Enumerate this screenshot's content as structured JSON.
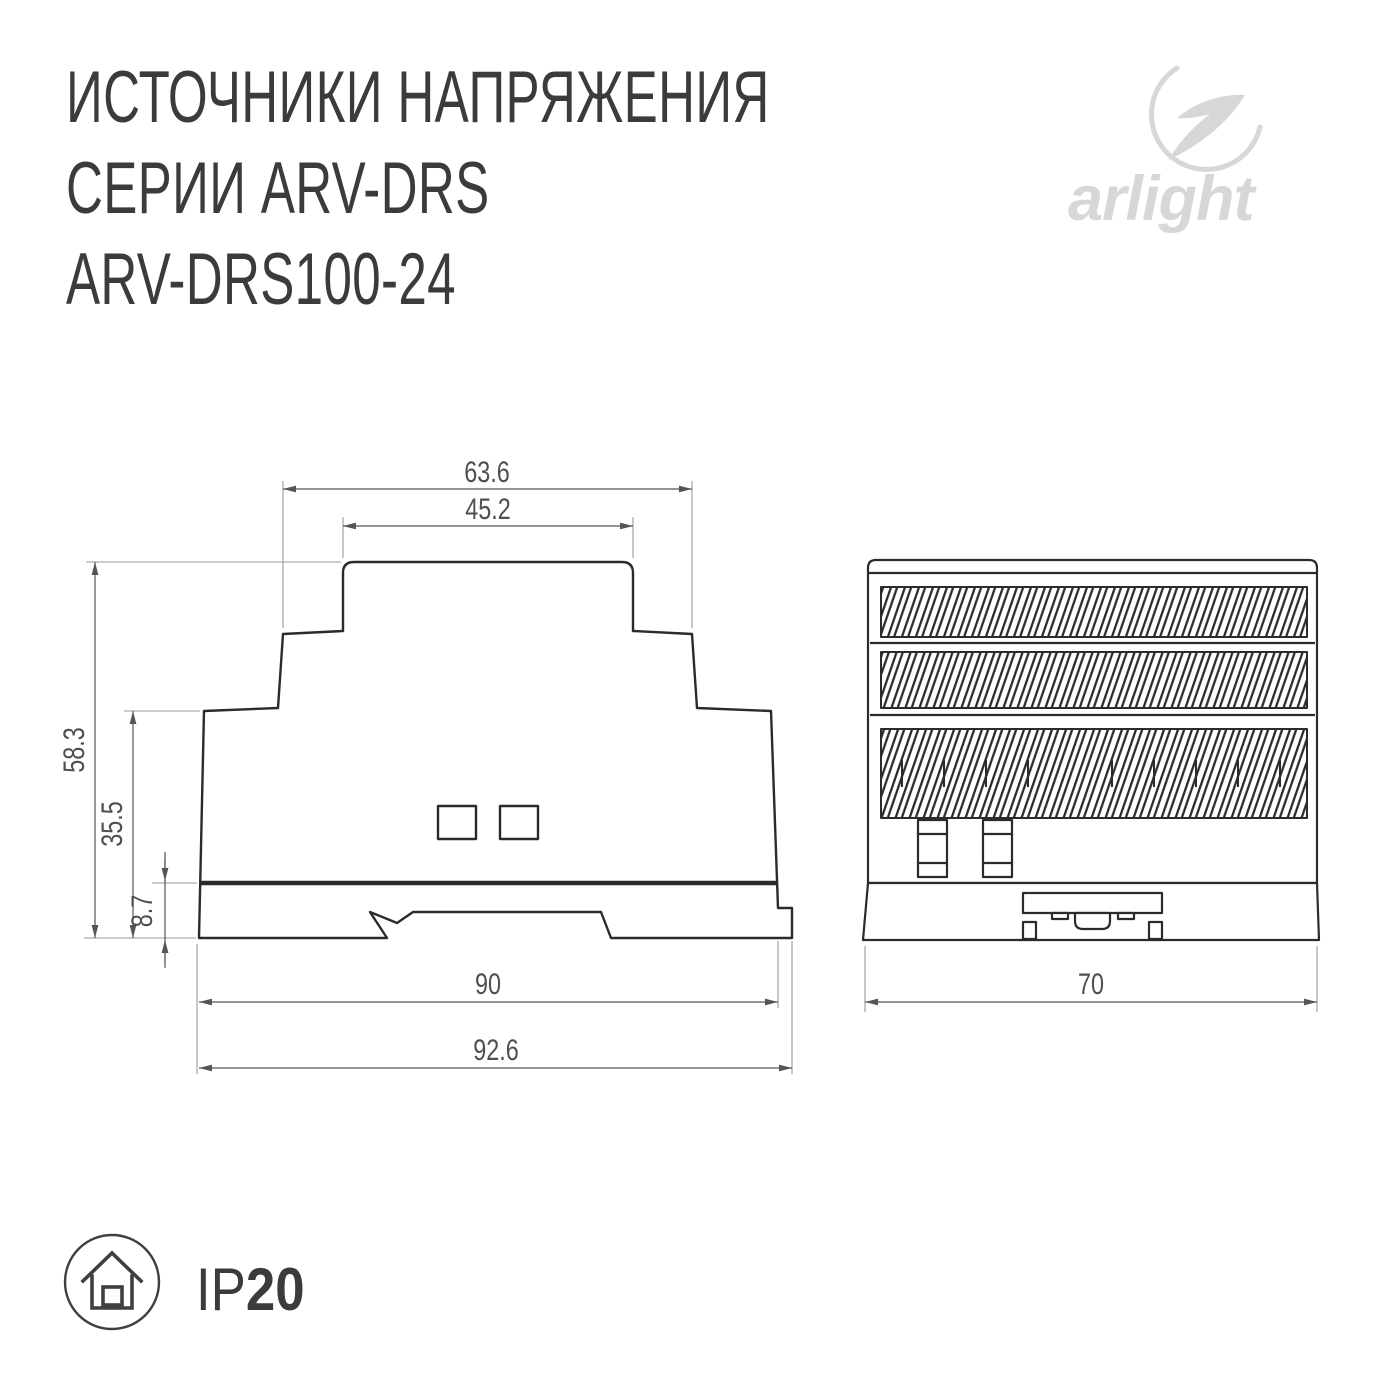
{
  "header": {
    "line1": "ИСТОЧНИКИ НАПРЯЖЕНИЯ",
    "line2": "СЕРИИ ARV-DRS",
    "line3": "ARV-DRS100-24"
  },
  "logo": {
    "wordmark": "arlight"
  },
  "front_view": {
    "dims": {
      "top_outer_width": "63.6",
      "cap_width": "45.2",
      "total_height": "58.3",
      "body_height": "35.5",
      "base_height": "8.7",
      "body_width": "90",
      "overall_width": "92.6"
    }
  },
  "side_view": {
    "dims": {
      "depth": "70"
    }
  },
  "ip_rating": {
    "prefix": "IP",
    "value": "20"
  },
  "colors": {
    "drawing_line": "#2b2b2b",
    "dim_line": "#555555",
    "ext_line": "#9a9a9a",
    "title_text": "#3b3b3b",
    "dim_text": "#4f4f4f",
    "logo_gray": "#d7d7d7"
  }
}
